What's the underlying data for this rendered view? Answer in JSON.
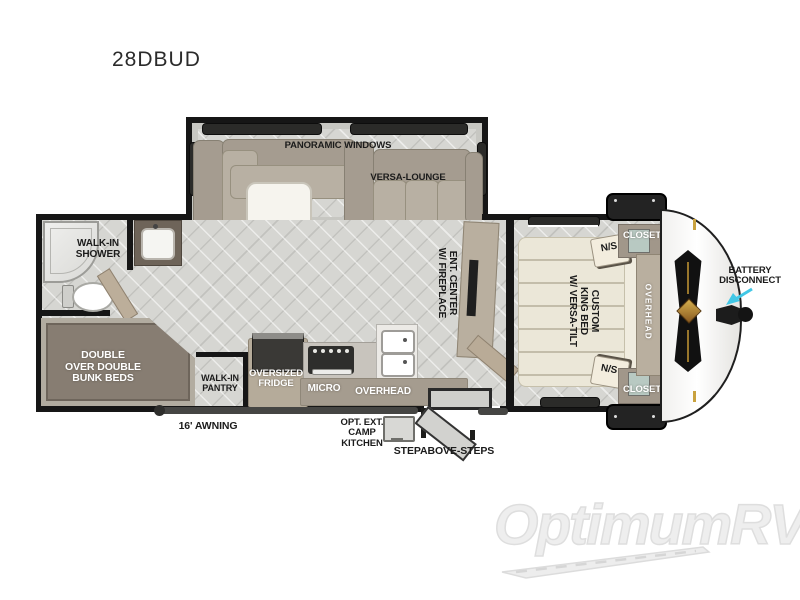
{
  "title": "28DBUD",
  "watermark": "OptimumRV",
  "colors": {
    "wall": "#161616",
    "floor": "#d6d6d2",
    "cabinet_tan": "#b5ab9a",
    "sofa_taupe": "#a59c90",
    "bed_cream": "#ebe7d8",
    "bunk_brown": "#877d72",
    "arrow_cyan": "#41c7e6",
    "badge_gold": "#c9a23f",
    "watermark_gray": "#eeeeee"
  },
  "living": {
    "panoramic_windows": "PANORAMIC WINDOWS",
    "versa_lounge": "VERSA-LOUNGE",
    "ent_center": [
      "ENT. CENTER",
      "W/ FIREPLACE"
    ]
  },
  "bathroom": {
    "walk_in_shower": [
      "WALK-IN",
      "SHOWER"
    ]
  },
  "bunk_room": {
    "bunk_beds": [
      "DOUBLE",
      "OVER DOUBLE",
      "BUNK BEDS"
    ]
  },
  "kitchen": {
    "pantry": [
      "WALK-IN",
      "PANTRY"
    ],
    "fridge": [
      "OVERSIZED",
      "FRIDGE"
    ],
    "micro": "MICRO",
    "overhead": "OVERHEAD"
  },
  "bedroom": {
    "bed": [
      "CUSTOM",
      "KING BED",
      "W/ VERSA-TILT"
    ],
    "ns_rear": "N/S",
    "ns_front": "N/S",
    "closet_rear": "CLOSET",
    "closet_front": "CLOSET",
    "overhead": "OVERHEAD"
  },
  "exterior": {
    "battery_disconnect": [
      "BATTERY",
      "DISCONNECT"
    ],
    "awning": "16' AWNING",
    "camp_kitchen": [
      "OPT. EXT.",
      "CAMP",
      "KITCHEN"
    ],
    "steps": "STEPABOVE-STEPS"
  }
}
